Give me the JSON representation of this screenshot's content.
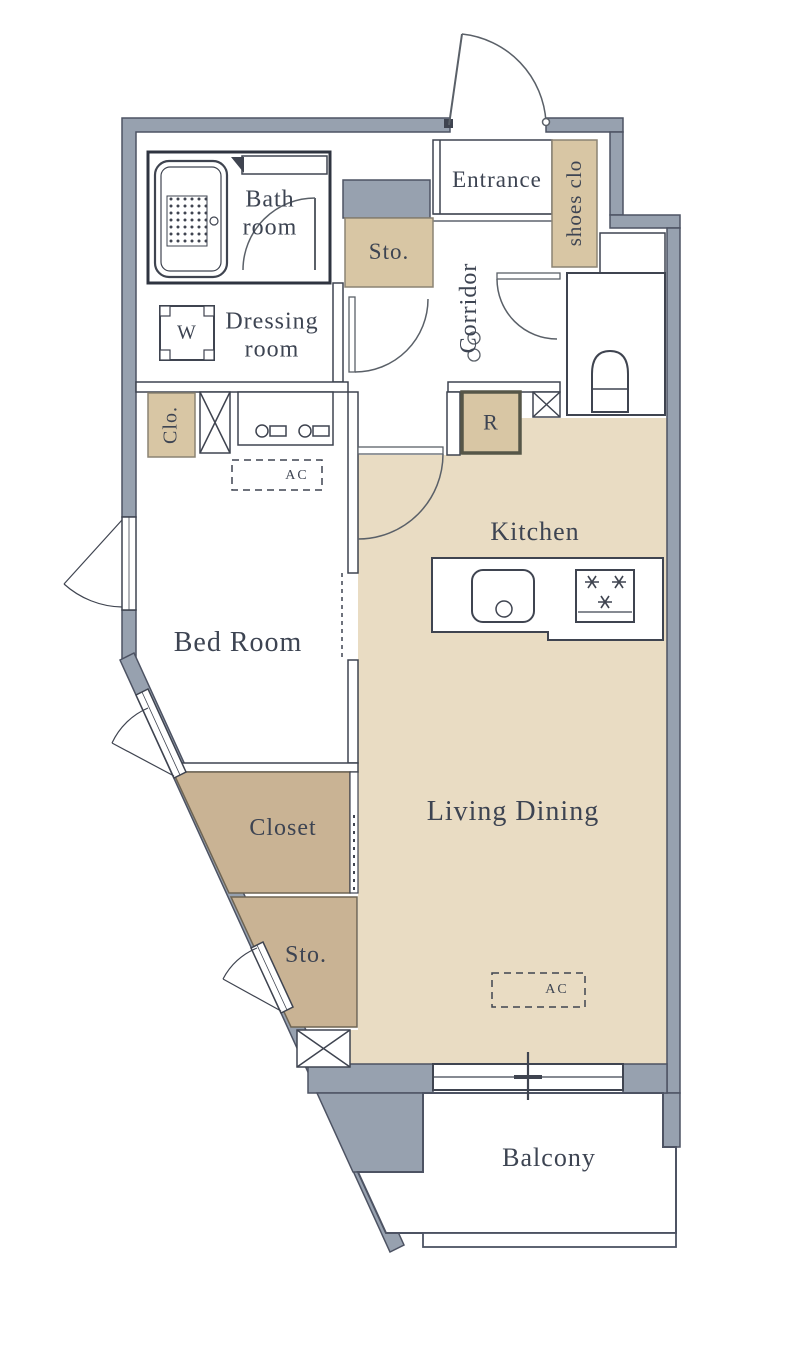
{
  "title": "Apartment floor plan",
  "colors": {
    "wall": "#97a1af",
    "wall_stroke": "#4d5363",
    "line": "#3f4450",
    "floor_tan": "#e9dcc3",
    "storage_dark": "#c9b394",
    "storage_dark_stroke": "#6f6553",
    "storage_light": "#d8c6a4",
    "storage_light_stroke": "#8b8373",
    "r_border": "#565648",
    "text": "#3d4452",
    "background": "#ffffff"
  },
  "rooms": {
    "bath": {
      "label": "Bath\nroom"
    },
    "dressing": {
      "label": "Dressing\nroom"
    },
    "entrance": {
      "label": "Entrance"
    },
    "shoes_closet": {
      "label": "shoes clo"
    },
    "storage_top": {
      "label": "Sto."
    },
    "corridor": {
      "label": "Corridor"
    },
    "closet_small": {
      "label": "Clo."
    },
    "washer": {
      "label": "W"
    },
    "refrigerator": {
      "label": "R"
    },
    "ac_bedroom": {
      "label": "AC"
    },
    "kitchen": {
      "label": "Kitchen"
    },
    "bedroom": {
      "label": "Bed Room"
    },
    "living_dining": {
      "label": "Living Dining"
    },
    "closet": {
      "label": "Closet"
    },
    "storage_bottom": {
      "label": "Sto."
    },
    "ac_living": {
      "label": "AC"
    },
    "balcony": {
      "label": "Balcony"
    }
  },
  "fixtures": [
    "bathtub",
    "shower-counter",
    "washing-machine",
    "vanity-sink",
    "toilet",
    "kitchen-sink",
    "stove",
    "entrance-door",
    "bath-door",
    "dressing-door",
    "toilet-door",
    "living-door",
    "casement-windows",
    "sliding-window",
    "shafts"
  ]
}
